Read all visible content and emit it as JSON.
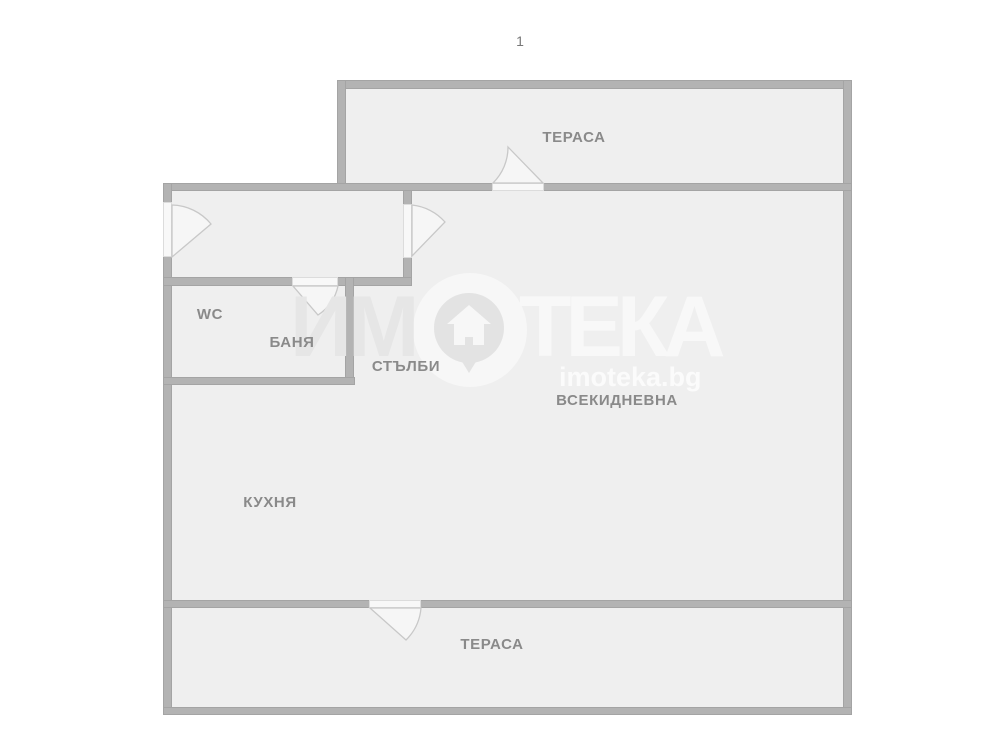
{
  "page": {
    "number": "1",
    "type": "floor-plan"
  },
  "labels": {
    "terrace_top": "ТЕРАСА",
    "wc": "WC",
    "bath": "БАНЯ",
    "stairs": "СТЪЛБИ",
    "living": "ВСЕКИДНЕВНА",
    "kitchen": "КУХНЯ",
    "terrace_bottom": "ТЕРАСА"
  },
  "watermark": {
    "left_text": "ИМ",
    "right_text": "ТЕКА",
    "domain": "imoteka.bg",
    "logo_icon": "house-pin-icon"
  },
  "colors": {
    "background": "#ffffff",
    "room_fill": "#efefef",
    "wall": "#b3b3b3",
    "wall_edge": "#a4a4a4",
    "door_gap": "#f8f8f8",
    "door_line": "#c8c8c8",
    "label_text": "#8a8a8a"
  }
}
